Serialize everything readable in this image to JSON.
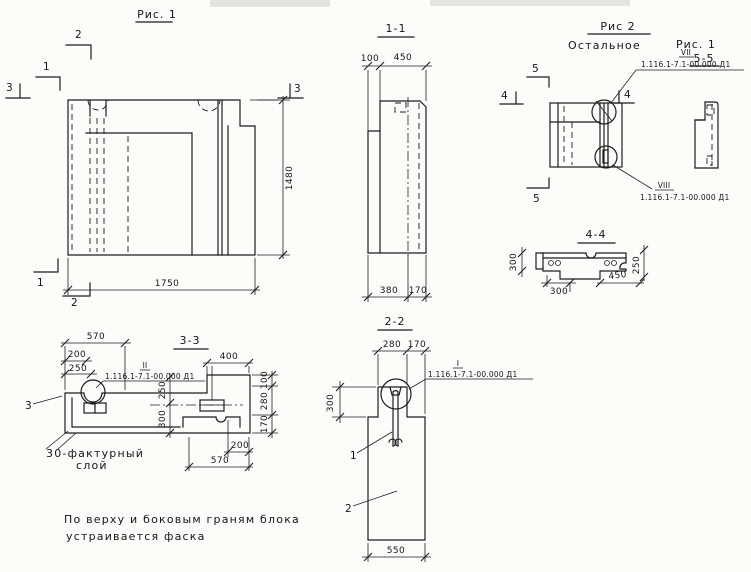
{
  "doc_ref": "1.116.1-7.1-00.000 Д1",
  "colors": {
    "ink": "#1d1d1d",
    "paper": "#fcfcf9"
  },
  "fig1": {
    "title": "Рис. 1",
    "marks": {
      "m1": "1",
      "m2": "2",
      "m3": "3"
    },
    "main_view": {
      "dim_length": "1750",
      "dim_height": "1480"
    },
    "section_1_1": {
      "title": "1-1",
      "dim_top_left": "100",
      "dim_top_right": "450",
      "dim_bottom_left": "380",
      "dim_bottom_right": "170"
    },
    "section_3_3": {
      "title": "3-3",
      "detail_label": "II",
      "dim_570_top": "570",
      "dim_200_top": "200",
      "dim_250_top": "250",
      "dim_400": "400",
      "dim_right_100": "100",
      "dim_right_280": "280",
      "dim_right_170": "170",
      "dim_inner_250": "250",
      "dim_inner_300": "300",
      "dim_bottom_200": "200",
      "dim_bottom_570": "570",
      "leader_mark": "3",
      "note_line1": "30-фактурный",
      "note_line2": "слой"
    },
    "section_2_2": {
      "title": "2-2",
      "detail_label": "I",
      "dim_top_280": "280",
      "dim_top_170": "170",
      "dim_left_300": "300",
      "dim_bottom_550": "550",
      "part_1": "1",
      "part_2": "2"
    }
  },
  "fig2": {
    "title": "Рис 2",
    "subtitle": "Остальное",
    "subtitle_ref": "Рис. 1",
    "marks": {
      "m4": "4",
      "m5": "5"
    },
    "detail_top_label": "VII",
    "detail_bottom_label": "VIII",
    "section_5_5": {
      "title": "5-5"
    },
    "section_4_4": {
      "title": "4-4",
      "dim_left_300": "300",
      "dim_bottom_300": "300",
      "dim_bottom_450": "450",
      "dim_right_250": "250"
    }
  },
  "note": {
    "line1": "По верху и боковым граням блока",
    "line2": "устраивается фаска"
  }
}
